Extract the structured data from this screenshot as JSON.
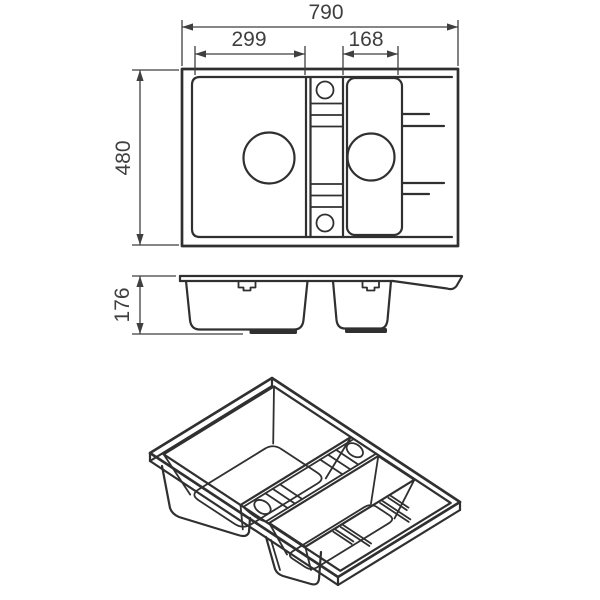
{
  "drawing": {
    "background_color": "#ffffff",
    "line_color": "#303030",
    "dimension_color": "#3f3f3f"
  },
  "dimensions": {
    "overall_width": "790",
    "left_bowl_width": "299",
    "right_bowl_width": "168",
    "overall_depth": "480",
    "bowl_height": "176"
  }
}
